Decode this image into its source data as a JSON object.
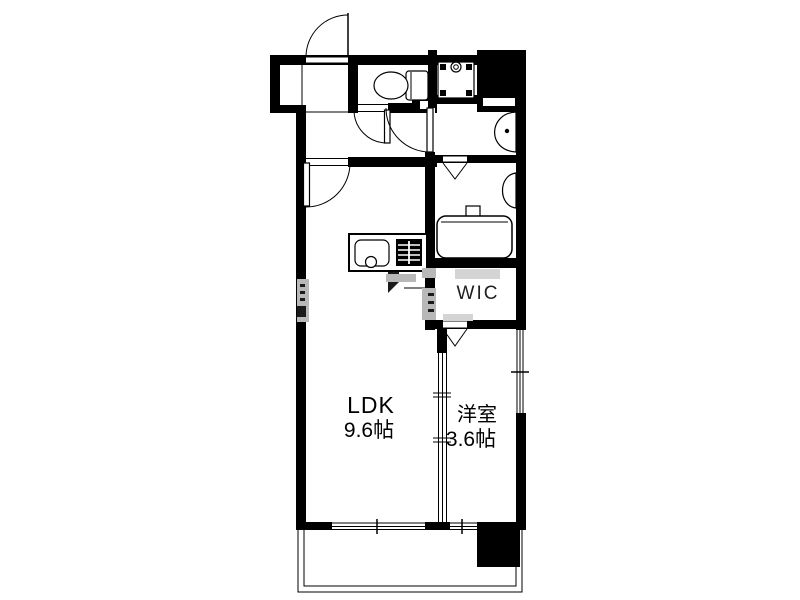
{
  "page": {
    "type": "floor-plan",
    "background": "#ffffff"
  },
  "floor_plan": {
    "labels": {
      "ldk_name": "LDK",
      "ldk_size": "9.6帖",
      "western_room_name": "洋室",
      "western_room_size": "3.6帖",
      "wic": "WIC"
    },
    "colors": {
      "wall": "#000000",
      "floor": "#ffffff",
      "line": "#000000",
      "watermark_gray": "#b8b8b8"
    },
    "fixtures": [
      "entrance-swing-door",
      "hall-swing-door",
      "toilet",
      "toilet-swing-door",
      "washing-machine-pan",
      "pipe-space-pillar",
      "washbasin",
      "washroom-swing-door",
      "bathroom-folding-door",
      "bathroom-counter",
      "bathtub",
      "kitchen-counter",
      "kitchen-sink",
      "gas-stove",
      "wic-folding-door",
      "sliding-partition-door",
      "window-right",
      "window-bottom-ldk",
      "window-bottom-western-room",
      "balcony",
      "balcony-pillar"
    ]
  }
}
